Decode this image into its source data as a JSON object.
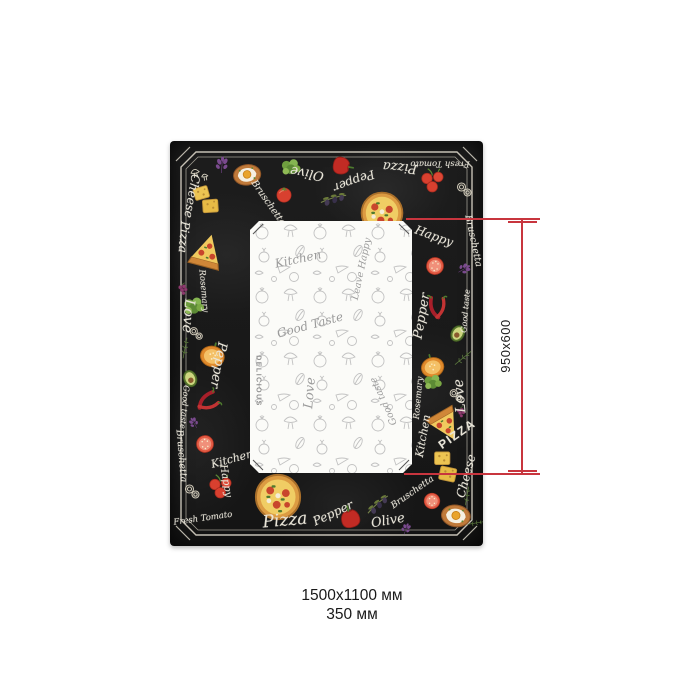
{
  "caption": {
    "line1": "1500х1100 мм",
    "line2": "350 мм"
  },
  "dimension_annotation": {
    "label": "950x600",
    "color": "#c8353e"
  },
  "tablecloth": {
    "colors": {
      "background": "#1b1b1b",
      "chalk_text": "#e9e5d8",
      "frame_line": "#d9d4c6",
      "panel_background": "#fbfbf8",
      "panel_sketch": "#c2c2c2"
    },
    "border_words": [
      {
        "text": "Olive",
        "x": 137,
        "y": 32,
        "r": 190,
        "fs": 13
      },
      {
        "text": "Pepper",
        "x": 184,
        "y": 40,
        "r": 160,
        "fs": 12
      },
      {
        "text": "Pizza",
        "x": 230,
        "y": 26,
        "r": 185,
        "fs": 13
      },
      {
        "text": "Fresh Tomato",
        "x": 270,
        "y": 22,
        "r": 180,
        "fs": 8.5
      },
      {
        "text": "Bruschetta",
        "x": 98,
        "y": 62,
        "r": 55,
        "fs": 9.5
      },
      {
        "text": "Happy",
        "x": 264,
        "y": 95,
        "r": 20,
        "fs": 12
      },
      {
        "text": "Bruschetta",
        "x": 303,
        "y": 100,
        "r": 78,
        "fs": 9.5
      },
      {
        "text": "Cheese",
        "x": 22,
        "y": 55,
        "r": 100,
        "fs": 12
      },
      {
        "text": "Pizza",
        "x": 14,
        "y": 96,
        "r": 95,
        "fs": 12
      },
      {
        "text": "Rosemary",
        "x": 33,
        "y": 150,
        "r": 85,
        "fs": 8.5
      },
      {
        "text": "Love",
        "x": 18,
        "y": 175,
        "r": 95,
        "fs": 14
      },
      {
        "text": "Pepper",
        "x": 48,
        "y": 224,
        "r": 100,
        "fs": 13
      },
      {
        "text": "Good taste",
        "x": 14,
        "y": 266,
        "r": 95,
        "fs": 8
      },
      {
        "text": "Bruschetta",
        "x": 11,
        "y": 315,
        "r": 85,
        "fs": 9.5
      },
      {
        "text": "Kitchen",
        "x": 62,
        "y": 318,
        "r": -15,
        "fs": 11
      },
      {
        "text": "Happy",
        "x": 55,
        "y": 340,
        "r": 80,
        "fs": 10
      },
      {
        "text": "Fresh Tomato",
        "x": 33,
        "y": 378,
        "r": -8,
        "fs": 8.5
      },
      {
        "text": "Pizza",
        "x": 115,
        "y": 380,
        "r": -5,
        "fs": 17
      },
      {
        "text": "Pepper",
        "x": 163,
        "y": 372,
        "r": -25,
        "fs": 12
      },
      {
        "text": "Olive",
        "x": 218,
        "y": 380,
        "r": -10,
        "fs": 13
      },
      {
        "text": "Bruschetta",
        "x": 243,
        "y": 352,
        "r": -35,
        "fs": 9
      },
      {
        "text": "Pepper",
        "x": 252,
        "y": 175,
        "r": -80,
        "fs": 13
      },
      {
        "text": "Good taste",
        "x": 296,
        "y": 170,
        "r": -85,
        "fs": 8
      },
      {
        "text": "Rosemary",
        "x": 249,
        "y": 257,
        "r": -85,
        "fs": 8.5
      },
      {
        "text": "Love",
        "x": 290,
        "y": 255,
        "r": -95,
        "fs": 14
      },
      {
        "text": "Kitchen",
        "x": 253,
        "y": 295,
        "r": -80,
        "fs": 11
      },
      {
        "text": "PIZZA",
        "x": 287,
        "y": 293,
        "r": -35,
        "fs": 12,
        "caps": true
      },
      {
        "text": "Cheese",
        "x": 296,
        "y": 335,
        "r": -75,
        "fs": 12
      }
    ],
    "border_icons": [
      {
        "icon": "mushrooms",
        "x": 29,
        "y": 33,
        "s": 22,
        "r": -10
      },
      {
        "icon": "basil",
        "x": 52,
        "y": 24,
        "s": 20,
        "r": 5
      },
      {
        "icon": "egg-toast",
        "x": 77,
        "y": 33,
        "s": 34,
        "r": -8
      },
      {
        "icon": "greens",
        "x": 121,
        "y": 27,
        "s": 26,
        "r": 0
      },
      {
        "icon": "tomato",
        "x": 114,
        "y": 53,
        "s": 22,
        "r": 0
      },
      {
        "icon": "olive-branch",
        "x": 163,
        "y": 57,
        "s": 30,
        "r": 15
      },
      {
        "icon": "pepper-red",
        "x": 173,
        "y": 25,
        "s": 26,
        "r": 100
      },
      {
        "icon": "pizza-whole",
        "x": 212,
        "y": 72,
        "s": 48,
        "r": 0
      },
      {
        "icon": "cherry-tomatoes",
        "x": 263,
        "y": 39,
        "s": 30,
        "r": 0
      },
      {
        "icon": "onion-rings",
        "x": 294,
        "y": 48,
        "s": 20,
        "r": 0
      },
      {
        "icon": "tomato-slice",
        "x": 265,
        "y": 125,
        "s": 26,
        "r": 10
      },
      {
        "icon": "basil",
        "x": 294,
        "y": 128,
        "s": 16,
        "r": 60
      },
      {
        "icon": "chili",
        "x": 267,
        "y": 167,
        "s": 30,
        "r": 10
      },
      {
        "icon": "avocado",
        "x": 288,
        "y": 192,
        "s": 24,
        "r": 30
      },
      {
        "icon": "pepper-orange",
        "x": 262,
        "y": 224,
        "s": 32,
        "r": -15
      },
      {
        "icon": "rosemary",
        "x": 293,
        "y": 217,
        "s": 22,
        "r": 10
      },
      {
        "icon": "greens",
        "x": 263,
        "y": 242,
        "s": 24,
        "r": 0
      },
      {
        "icon": "onion-rings",
        "x": 286,
        "y": 254,
        "s": 18,
        "r": 0
      },
      {
        "icon": "grapes",
        "x": 291,
        "y": 272,
        "s": 16,
        "r": 0
      },
      {
        "icon": "pizza-slice",
        "x": 276,
        "y": 284,
        "s": 40,
        "r": -30
      },
      {
        "icon": "cheese-crackers",
        "x": 276,
        "y": 326,
        "s": 36,
        "r": 8
      },
      {
        "icon": "rosemary",
        "x": 297,
        "y": 355,
        "s": 20,
        "r": -30
      },
      {
        "icon": "basil",
        "x": 24,
        "y": 282,
        "s": 14,
        "r": -30
      },
      {
        "icon": "tomato-slice",
        "x": 35,
        "y": 303,
        "s": 26,
        "r": -5
      },
      {
        "icon": "onion-rings",
        "x": 22,
        "y": 350,
        "s": 20,
        "r": 0
      },
      {
        "icon": "cherry-tomatoes",
        "x": 51,
        "y": 345,
        "s": 30,
        "r": 0
      },
      {
        "icon": "pizza-whole",
        "x": 108,
        "y": 356,
        "s": 52,
        "r": 0
      },
      {
        "icon": "pepper-red",
        "x": 180,
        "y": 376,
        "s": 28,
        "r": -15
      },
      {
        "icon": "olive-branch",
        "x": 207,
        "y": 363,
        "s": 30,
        "r": -10
      },
      {
        "icon": "basil",
        "x": 236,
        "y": 388,
        "s": 14,
        "r": 20
      },
      {
        "icon": "tomato-slice",
        "x": 262,
        "y": 360,
        "s": 24,
        "r": 0
      },
      {
        "icon": "egg-toast",
        "x": 286,
        "y": 374,
        "s": 36,
        "r": 8
      },
      {
        "icon": "rosemary",
        "x": 306,
        "y": 382,
        "s": 18,
        "r": 40
      },
      {
        "icon": "cheese-crackers",
        "x": 37,
        "y": 59,
        "s": 34,
        "r": -8
      },
      {
        "icon": "pizza-slice",
        "x": 37,
        "y": 111,
        "s": 42,
        "r": 195
      },
      {
        "icon": "grapes",
        "x": 13,
        "y": 149,
        "s": 18,
        "r": 0
      },
      {
        "icon": "greens",
        "x": 24,
        "y": 166,
        "s": 28,
        "r": 0
      },
      {
        "icon": "onion-rings",
        "x": 26,
        "y": 192,
        "s": 18,
        "r": 0
      },
      {
        "icon": "rosemary",
        "x": 15,
        "y": 207,
        "s": 22,
        "r": -30
      },
      {
        "icon": "pepper-orange",
        "x": 43,
        "y": 213,
        "s": 34,
        "r": 15
      },
      {
        "icon": "avocado",
        "x": 20,
        "y": 237,
        "s": 24,
        "r": -20
      },
      {
        "icon": "chili",
        "x": 37,
        "y": 261,
        "s": 30,
        "r": 70
      }
    ],
    "panel_words": [
      {
        "text": "Kitchen",
        "x": 48,
        "y": 38,
        "r": -12,
        "fs": 12
      },
      {
        "text": "Leave Happy",
        "x": 112,
        "y": 48,
        "r": -78,
        "fs": 9.5
      },
      {
        "text": "Good Taste",
        "x": 60,
        "y": 104,
        "r": -15,
        "fs": 12
      },
      {
        "text": "DELICIOUS",
        "x": 8,
        "y": 160,
        "r": 90,
        "fs": 7,
        "caps": true
      },
      {
        "text": "Love",
        "x": 60,
        "y": 172,
        "r": -85,
        "fs": 13
      },
      {
        "text": "Good taste",
        "x": 134,
        "y": 180,
        "r": -115,
        "fs": 9.5
      }
    ]
  }
}
